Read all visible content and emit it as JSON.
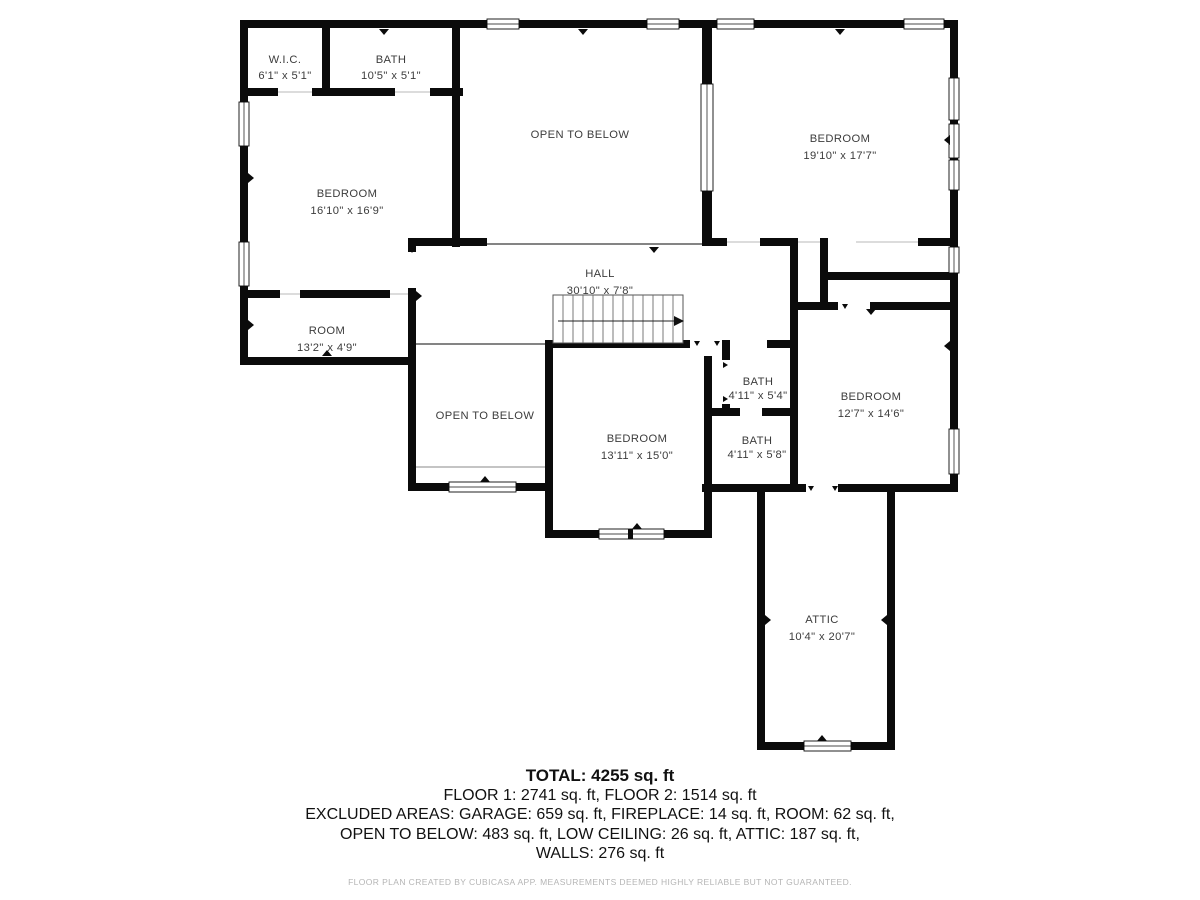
{
  "colors": {
    "wall": "#0b0b0b",
    "label": "#3c3c3c",
    "footer_gray": "#b5b5b5"
  },
  "rooms": [
    {
      "name": "W.I.C.",
      "dims": "6'1\" x 5'1\""
    },
    {
      "name": "BATH",
      "dims": "10'5\" x 5'1\""
    },
    {
      "name": "OPEN TO BELOW",
      "dims": ""
    },
    {
      "name": "BEDROOM",
      "dims": "19'10\" x 17'7\""
    },
    {
      "name": "BEDROOM",
      "dims": "16'10\" x 16'9\""
    },
    {
      "name": "HALL",
      "dims": "30'10\" x 7'8\""
    },
    {
      "name": "ROOM",
      "dims": "13'2\" x 4'9\""
    },
    {
      "name": "OPEN TO BELOW",
      "dims": ""
    },
    {
      "name": "BEDROOM",
      "dims": "13'11\" x 15'0\""
    },
    {
      "name": "BATH",
      "dims": "4'11\" x 5'4\""
    },
    {
      "name": "BATH",
      "dims": "4'11\" x 5'8\""
    },
    {
      "name": "BEDROOM",
      "dims": "12'7\" x 14'6\""
    },
    {
      "name": "ATTIC",
      "dims": "10'4\" x 20'7\""
    }
  ],
  "summary": {
    "total": "TOTAL: 4255 sq. ft",
    "floors": "FLOOR 1: 2741 sq. ft, FLOOR 2: 1514 sq. ft",
    "excluded_line1": "EXCLUDED AREAS: GARAGE: 659 sq. ft, FIREPLACE: 14 sq. ft, ROOM: 62 sq. ft,",
    "excluded_line2": "OPEN TO BELOW: 483 sq. ft, LOW CEILING: 26 sq. ft, ATTIC: 187 sq. ft,",
    "excluded_line3": "WALLS: 276 sq. ft"
  },
  "footer": "FLOOR PLAN CREATED BY CUBICASA APP. MEASUREMENTS DEEMED HIGHLY RELIABLE BUT NOT GUARANTEED."
}
